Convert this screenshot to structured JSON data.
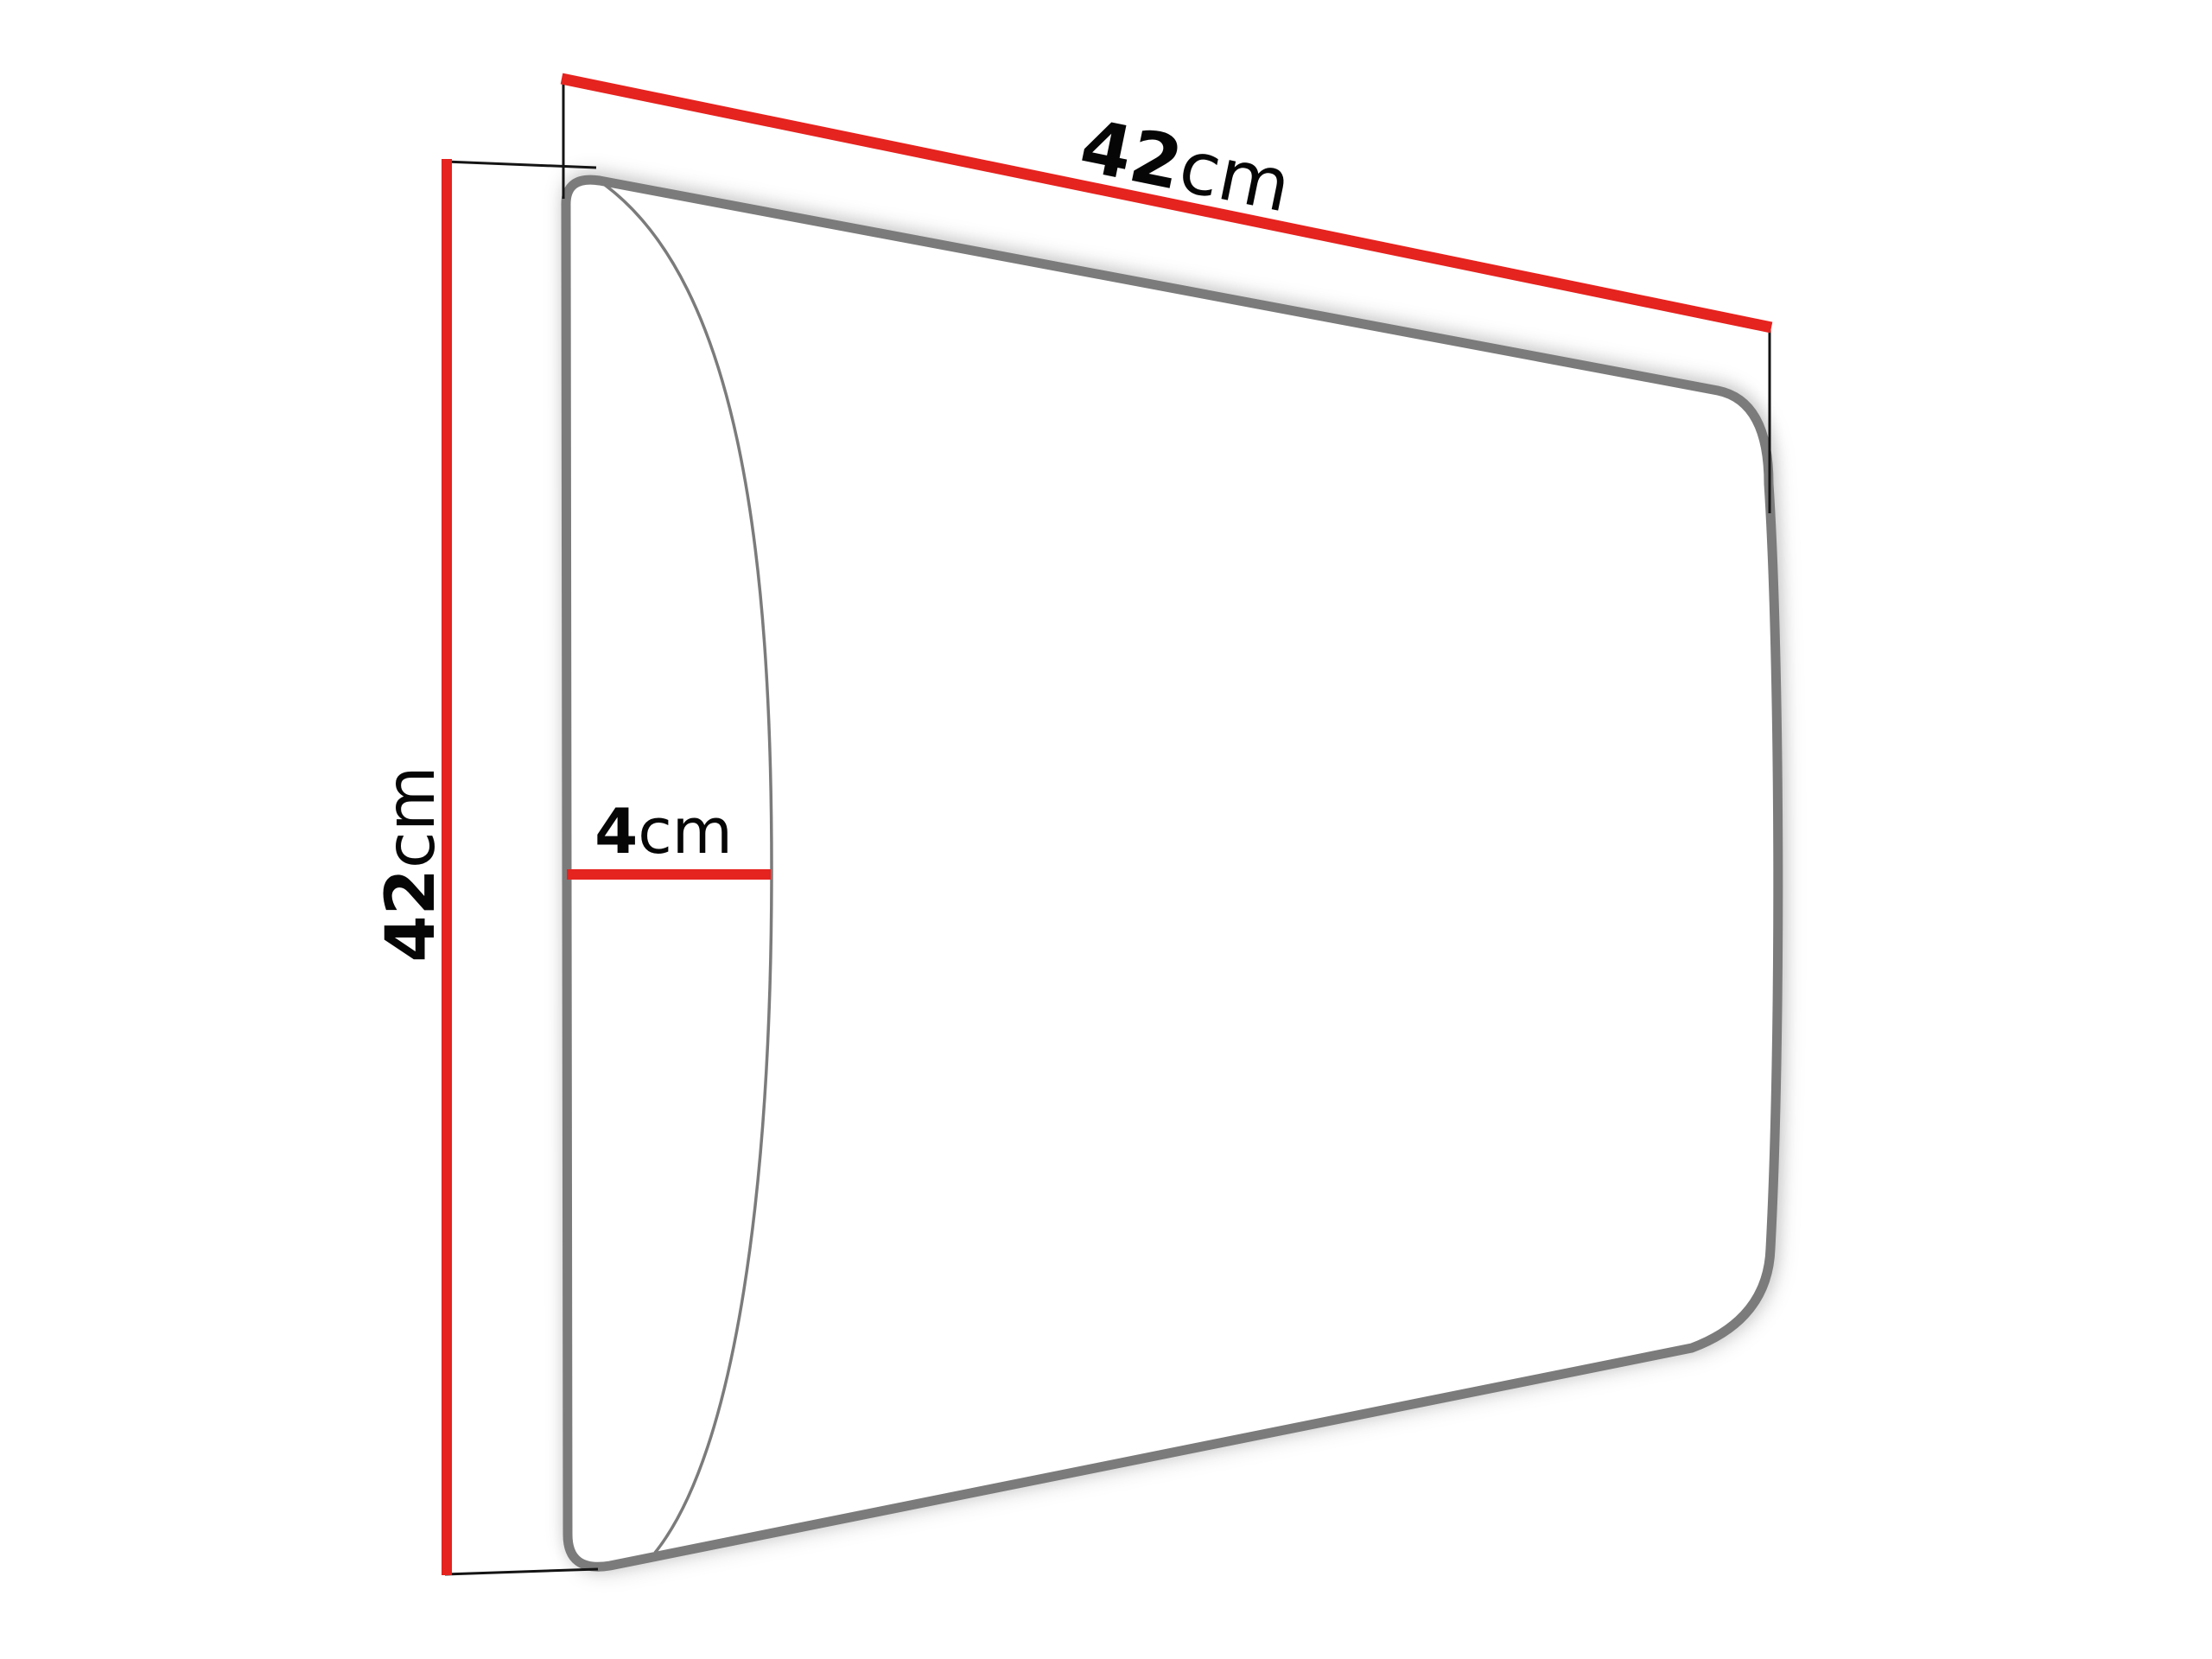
{
  "diagram": {
    "subject": "upholstered-wall-panel-dimension-drawing",
    "dimensions": {
      "width": {
        "value": "42",
        "unit": "cm"
      },
      "height": {
        "value": "42",
        "unit": "cm"
      },
      "depth": {
        "value": "4",
        "unit": "cm"
      }
    },
    "colors": {
      "dimension_line": "#e5231f",
      "extension_line": "#141414",
      "outline": "#7b7b7b",
      "bulge_line": "#7b7b7b",
      "panel_fill": "#ffffff",
      "text": "#060606",
      "background": "#ffffff"
    }
  }
}
